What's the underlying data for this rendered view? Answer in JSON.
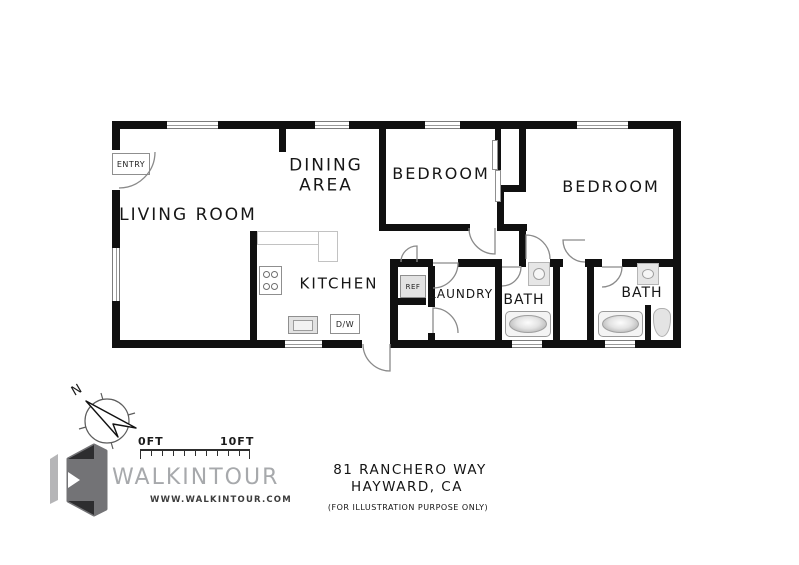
{
  "plan": {
    "rooms": {
      "living_room": "LIVING ROOM",
      "dining_area": "DINING\nAREA",
      "bedroom_1": "BEDROOM",
      "bedroom_2": "BEDROOM",
      "kitchen": "KITCHEN",
      "laundry": "LAUNDRY",
      "bath_1": "BATH",
      "bath_2": "BATH"
    },
    "fixtures": {
      "entry": "ENTRY",
      "refrigerator": "REF",
      "dishwasher": "D/W"
    }
  },
  "footer": {
    "compass_north": "N",
    "scale_start": "0FT",
    "scale_end": "10FT",
    "brand": "WALKINTOUR",
    "website": "WWW.WALKINTOUR.COM",
    "address_line_1": "81 RANCHERO WAY",
    "address_line_2": "HAYWARD, CA",
    "disclaimer": "(FOR ILLUSTRATION PURPOSE ONLY)"
  },
  "colors": {
    "wall": "#101010",
    "fixture_fill": "#e2e2e2",
    "fixture_line": "#8f8f8f",
    "brand_gray": "#a7a9ac",
    "logo_dark": "#2d2d2f",
    "logo_mid": "#737376",
    "logo_light": "#b5b5b7"
  }
}
